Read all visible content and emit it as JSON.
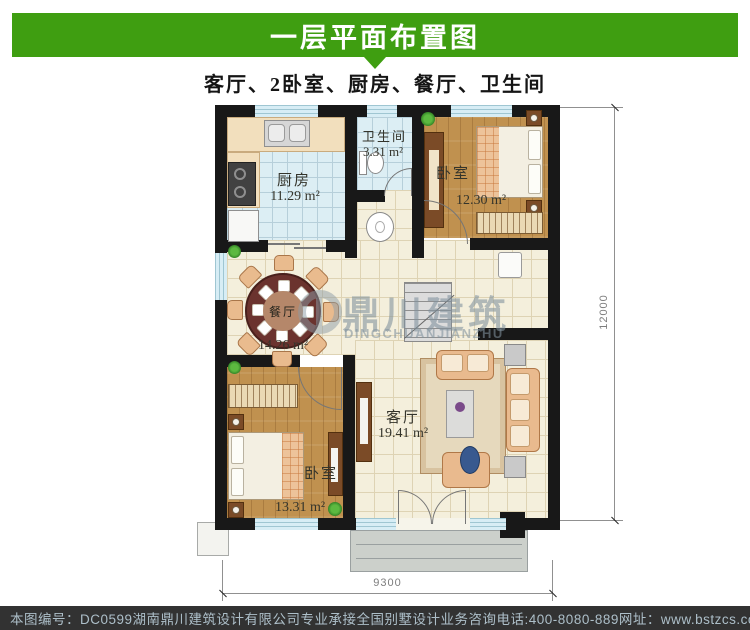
{
  "header": {
    "title": "一层平面布置图",
    "subtitle": "客厅、2卧室、厨房、餐厅、卫生间",
    "bar_color": "#3f9e11"
  },
  "rooms": {
    "kitchen": {
      "name": "厨房",
      "area": "11.29 m²"
    },
    "bathroom": {
      "name": "卫生间",
      "area": "3.31 m²"
    },
    "bedroom_top": {
      "name": "卧室",
      "area": "12.30 m²"
    },
    "dining": {
      "name": "餐厅",
      "area": "14.26 m²"
    },
    "bedroom_bottom": {
      "name": "卧室",
      "area": "13.31 m²"
    },
    "living": {
      "name": "客厅",
      "area": "19.41 m²"
    }
  },
  "dimensions": {
    "width": "9300",
    "height": "12000"
  },
  "watermark": {
    "cn": "鼎川建筑",
    "en": "DINGCHUANJIANZHU"
  },
  "footer": {
    "plan_no": "本图编号：DC0599",
    "company": "湖南鼎川建筑设计有限公司专业承接全国别墅设计业务",
    "phone": "咨询电话:400-8080-889",
    "website": "网址：www.bstzcs.com",
    "bg_color": "#323232",
    "text_color": "#adbfc9"
  }
}
